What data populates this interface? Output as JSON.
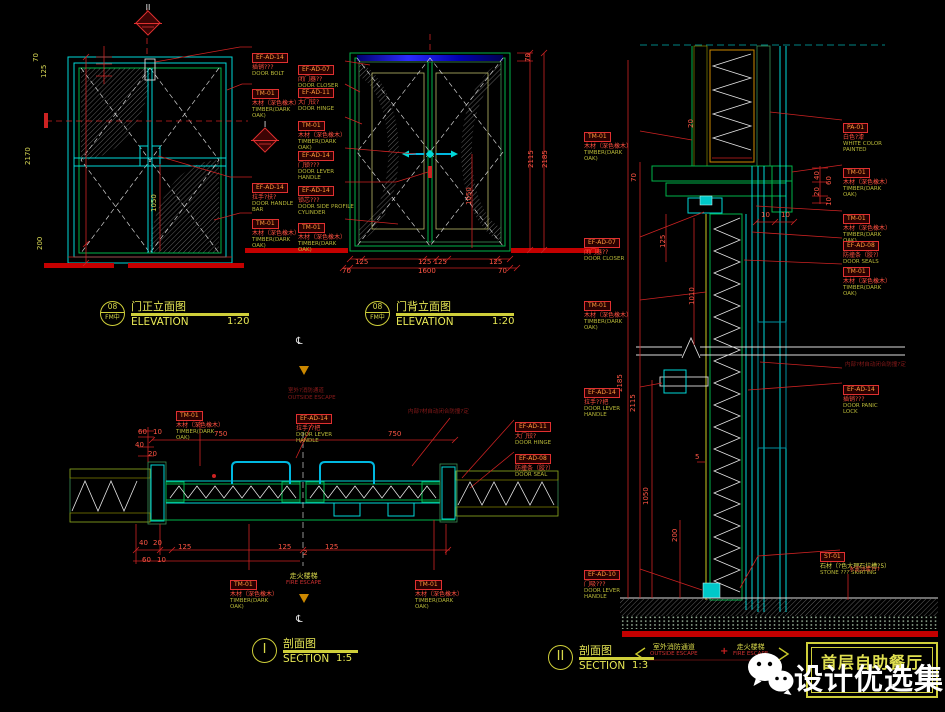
{
  "title_block": {
    "project": "首层自助餐厅"
  },
  "watermark": {
    "name": "设计优选集",
    "icon": "wechat-icon"
  },
  "colors": {
    "background": "#000000",
    "cyan": "#00d9d9",
    "green": "#00b44a",
    "red": "#cc2222",
    "yellow": "#cfcf3a",
    "dark_red": "#7a1616",
    "white": "#ffffff",
    "blue": "#2222cc",
    "orange": "#cc8800"
  },
  "captions": [
    {
      "x": 100,
      "y": 301,
      "circle": [
        "08",
        "FM中"
      ],
      "cn": "门正立面图",
      "en": "ELEVATION",
      "scale": "1:20",
      "w": 118
    },
    {
      "x": 365,
      "y": 301,
      "circle": [
        "08",
        "FM中"
      ],
      "cn": "门背立面图",
      "en": "ELEVATION",
      "scale": "1:20",
      "w": 118
    },
    {
      "x": 252,
      "y": 638,
      "circle": [
        "I"
      ],
      "cn": "剖面图",
      "en": "SECTION",
      "scale": "1:5",
      "w": 75
    },
    {
      "x": 548,
      "y": 645,
      "circle": [
        "II"
      ],
      "cn": "剖面图",
      "en": "SECTION",
      "scale": "1:3",
      "w": 75
    }
  ],
  "markers": [
    {
      "x": 134,
      "y": 3,
      "label": "II"
    },
    {
      "x": 251,
      "y": 120,
      "label": "I"
    }
  ],
  "labels": [
    {
      "x": 252,
      "y": 44,
      "code": "EF-AD-14",
      "cn": "插销???",
      "en": "DOOR BOLT"
    },
    {
      "x": 252,
      "y": 80,
      "code": "TM-01",
      "cn": "木材（深色橡木）",
      "en": "TIMBER(DARK OAK)"
    },
    {
      "x": 252,
      "y": 174,
      "code": "EF-AD-14",
      "cn": "拉手?扶?",
      "en": "DOOR HANDLE BAR"
    },
    {
      "x": 252,
      "y": 210,
      "code": "TM-01",
      "cn": "木材（深色橡木）",
      "en": "TIMBER(DARK OAK)"
    },
    {
      "x": 298,
      "y": 56,
      "code": "EF-AD-07",
      "cn": "闭门器??",
      "en": "DOOR CLOSER"
    },
    {
      "x": 298,
      "y": 79,
      "code": "EF-AD-11",
      "cn": "大门铰?",
      "en": "DOOR HINGE"
    },
    {
      "x": 298,
      "y": 112,
      "code": "TM-01",
      "cn": "木材（深色橡木）",
      "en": "TIMBER(DARK OAK)"
    },
    {
      "x": 298,
      "y": 142,
      "code": "EF-AD-14",
      "cn": "门锁???",
      "en": "DOOR LEVER HANDLE"
    },
    {
      "x": 298,
      "y": 177,
      "code": "EF-AD-14",
      "cn": "锁芯???",
      "en": "DOOR SIDE PROFILE CYLINDER",
      "w": 60
    },
    {
      "x": 298,
      "y": 214,
      "code": "TM-01",
      "cn": "木材（深色橡木）",
      "en": "TIMBER(DARK OAK)"
    },
    {
      "x": 176,
      "y": 402,
      "code": "TM-01",
      "cn": "木材（深色橡木）",
      "en": "TIMBER(DARK OAK)"
    },
    {
      "x": 296,
      "y": 405,
      "code": "EF-AD-14",
      "cn": "拉手??把",
      "en": "DOOR LEVER HANDLE"
    },
    {
      "x": 515,
      "y": 413,
      "code": "EF-AD-11",
      "cn": "大门铰?",
      "en": "DOOR HINGE"
    },
    {
      "x": 515,
      "y": 445,
      "code": "EF-AD-08",
      "cn": "防撞条（胶?）",
      "en": "DOOR SEAL"
    },
    {
      "x": 230,
      "y": 571,
      "code": "TM-01",
      "cn": "木材（深色橡木）",
      "en": "TIMBER(DARK OAK)"
    },
    {
      "x": 415,
      "y": 571,
      "code": "TM-01",
      "cn": "木材（深色橡木）",
      "en": "TIMBER(DARK OAK)"
    },
    {
      "x": 584,
      "y": 123,
      "code": "TM-01",
      "cn": "木材（深色橡木）",
      "en": "TIMBER(DARK OAK)"
    },
    {
      "x": 584,
      "y": 229,
      "code": "EF-AD-07",
      "cn": "闭门器??",
      "en": "DOOR CLOSER"
    },
    {
      "x": 584,
      "y": 292,
      "code": "TM-01",
      "cn": "木材（深色橡木）",
      "en": "TIMBER(DARK OAK)"
    },
    {
      "x": 584,
      "y": 379,
      "code": "EF-AD-14",
      "cn": "拉手??把",
      "en": "DOOR LEVER HANDLE"
    },
    {
      "x": 584,
      "y": 561,
      "code": "EF-AD-10",
      "cn": "门吸???",
      "en": "DOOR LEVER HANDLE"
    },
    {
      "x": 843,
      "y": 114,
      "code": "PA-01",
      "cn": "白色?漆",
      "en": "WHITE COLOR PAINTED"
    },
    {
      "x": 843,
      "y": 159,
      "code": "TM-01",
      "cn": "木材（深色橡木）",
      "en": "TIMBER(DARK OAK)"
    },
    {
      "x": 843,
      "y": 205,
      "code": "TM-01",
      "cn": "木材（深色橡木）",
      "en": "TIMBER(DARK OAK)"
    },
    {
      "x": 843,
      "y": 232,
      "code": "EF-AD-08",
      "cn": "防撞条（胶?）",
      "en": "DOOR SEALS"
    },
    {
      "x": 843,
      "y": 258,
      "code": "TM-01",
      "cn": "木材（深色橡木）",
      "en": "TIMBER(DARK OAK)"
    },
    {
      "x": 843,
      "y": 376,
      "code": "EF-AD-14",
      "cn": "插销???",
      "en": "DOOR PANIC LOCK"
    },
    {
      "x": 820,
      "y": 543,
      "code": "ST-01",
      "cn": "石材（?色大理石拉槽?5）",
      "en": "STONE ??? SKIRTING",
      "yellow": true,
      "w": 95
    }
  ],
  "notes": [
    {
      "x": 288,
      "y": 388,
      "cls": "darkred",
      "cn": "室外?消防通道",
      "en": "OUTSIDE ESCAPE"
    },
    {
      "x": 408,
      "y": 409,
      "cls": "darkred",
      "cn": "内部?材自动闭合防撞?定"
    },
    {
      "x": 845,
      "y": 362,
      "cls": "darkred",
      "cn": "内部?材自动闭合防撞?定"
    },
    {
      "x": 849,
      "y": 567,
      "cls": "red",
      "cn": "水泥沙浆???"
    },
    {
      "x": 286,
      "y": 572,
      "cls": "fire",
      "cn": "走火楼梯",
      "en": "FIRE ESCAPE"
    },
    {
      "x": 650,
      "y": 643,
      "cls": "fire",
      "cn": "室外消防通道",
      "en": "OUTSIDE ESCAPE"
    },
    {
      "x": 733,
      "y": 643,
      "cls": "fire",
      "cn": "走火楼梯",
      "en": "FIRE ESCAPE"
    }
  ],
  "dims": [
    {
      "t": "70",
      "x": 32,
      "y": 62,
      "rot": true,
      "c": "yel"
    },
    {
      "t": "125",
      "x": 40,
      "y": 78,
      "rot": true,
      "c": "yel"
    },
    {
      "t": "2170",
      "x": 24,
      "y": 165,
      "rot": true,
      "c": "yel"
    },
    {
      "t": "200",
      "x": 36,
      "y": 250,
      "rot": true,
      "c": "yel"
    },
    {
      "t": "1050",
      "x": 150,
      "y": 212,
      "rot": true,
      "c": "yel"
    },
    {
      "t": "70",
      "x": 524,
      "y": 62,
      "rot": true
    },
    {
      "t": "2115",
      "x": 527,
      "y": 168,
      "rot": true
    },
    {
      "t": "2185",
      "x": 541,
      "y": 168,
      "rot": true
    },
    {
      "t": "1050",
      "x": 465,
      "y": 205,
      "rot": true
    },
    {
      "t": "125",
      "x": 355,
      "y": 258
    },
    {
      "t": "125 125",
      "x": 418,
      "y": 258
    },
    {
      "t": "125",
      "x": 489,
      "y": 258
    },
    {
      "t": "70",
      "x": 342,
      "y": 267
    },
    {
      "t": "1600",
      "x": 418,
      "y": 267
    },
    {
      "t": "70",
      "x": 498,
      "y": 267
    },
    {
      "t": "60",
      "x": 138,
      "y": 428
    },
    {
      "t": "10",
      "x": 153,
      "y": 428
    },
    {
      "t": "40",
      "x": 135,
      "y": 441
    },
    {
      "t": "20",
      "x": 148,
      "y": 450
    },
    {
      "t": "750",
      "x": 214,
      "y": 430
    },
    {
      "t": "750",
      "x": 388,
      "y": 430
    },
    {
      "t": "40",
      "x": 139,
      "y": 539
    },
    {
      "t": "20",
      "x": 153,
      "y": 539
    },
    {
      "t": "125",
      "x": 178,
      "y": 543
    },
    {
      "t": "125",
      "x": 278,
      "y": 543
    },
    {
      "t": "125",
      "x": 325,
      "y": 543
    },
    {
      "t": "60",
      "x": 142,
      "y": 556
    },
    {
      "t": "10",
      "x": 157,
      "y": 556
    },
    {
      "t": "2",
      "x": 303,
      "y": 549
    },
    {
      "t": "20",
      "x": 687,
      "y": 128,
      "rot": true
    },
    {
      "t": "70",
      "x": 630,
      "y": 182,
      "rot": true
    },
    {
      "t": "125",
      "x": 659,
      "y": 248,
      "rot": true
    },
    {
      "t": "1010",
      "x": 688,
      "y": 305,
      "rot": true
    },
    {
      "t": "10",
      "x": 761,
      "y": 211
    },
    {
      "t": "10",
      "x": 781,
      "y": 211
    },
    {
      "t": "40",
      "x": 813,
      "y": 180,
      "rot": true
    },
    {
      "t": "60",
      "x": 825,
      "y": 185,
      "rot": true
    },
    {
      "t": "20",
      "x": 813,
      "y": 196,
      "rot": true
    },
    {
      "t": "10",
      "x": 825,
      "y": 206,
      "rot": true
    },
    {
      "t": "2185",
      "x": 616,
      "y": 392,
      "rot": true
    },
    {
      "t": "2115",
      "x": 629,
      "y": 412,
      "rot": true
    },
    {
      "t": "1050",
      "x": 642,
      "y": 505,
      "rot": true
    },
    {
      "t": "200",
      "x": 671,
      "y": 542,
      "rot": true
    },
    {
      "t": "5",
      "x": 695,
      "y": 453
    }
  ],
  "symbols": [
    {
      "type": "centerline",
      "x": 296,
      "y": 336
    },
    {
      "type": "arrow-down",
      "x": 299,
      "y": 366
    },
    {
      "type": "arrow-down",
      "x": 299,
      "y": 594
    },
    {
      "type": "centerline",
      "x": 296,
      "y": 614
    },
    {
      "type": "plus",
      "x": 720,
      "y": 646
    }
  ]
}
